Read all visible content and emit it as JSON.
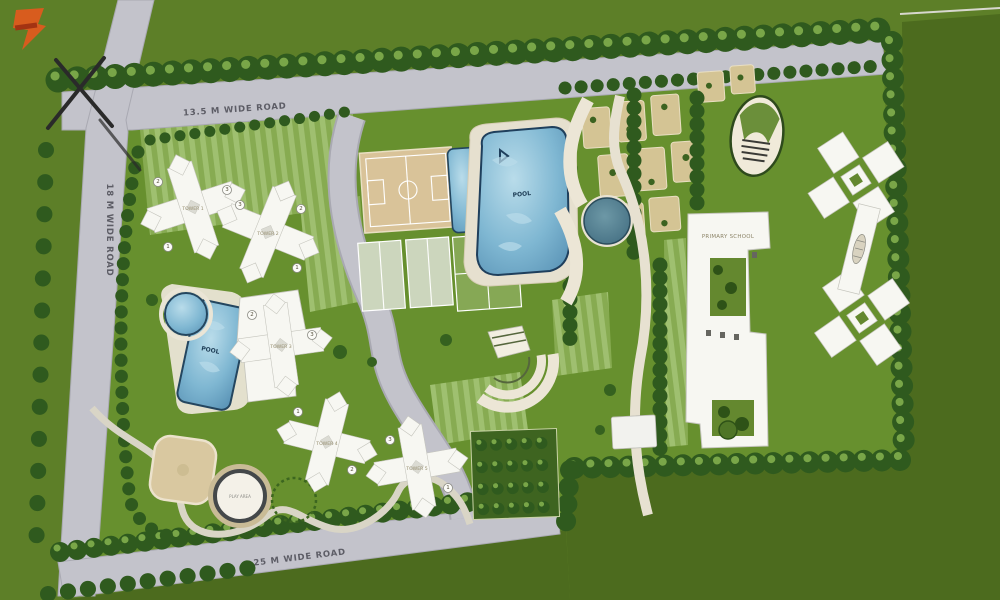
{
  "meta": {
    "kind": "residential-township-site-plan"
  },
  "roads": {
    "top": "13.5 M WIDE ROAD",
    "left": "18 M WIDE ROAD",
    "bottom": "25 M WIDE ROAD"
  },
  "buildings": {
    "school": "PRIMARY SCHOOL",
    "towers": [
      {
        "label": "TOWER 1"
      },
      {
        "label": "TOWER 2"
      },
      {
        "label": "TOWER 3"
      },
      {
        "label": "TOWER 4"
      },
      {
        "label": "TOWER 5"
      }
    ]
  },
  "amenities": {
    "pool_main": "POOL",
    "pool_left": "POOL",
    "play_area": "PLAY AREA"
  },
  "badges": [
    "2",
    "3",
    "1",
    "3",
    "2",
    "1",
    "2",
    "3",
    "1",
    "2",
    "3",
    "1"
  ],
  "colors": {
    "lawn": "#67902e",
    "outer_green": "#4c6b1e",
    "base_green": "#5d7f28",
    "road": "#c3c3cb",
    "path": "#ece6d6",
    "tree": "#2f5a1e",
    "building": "#f7f7f2",
    "pool_water": "#7fb7d2",
    "pool_edge": "#23455e",
    "court_tan": "#d9c399",
    "logo_orange": "#d85c1e"
  }
}
